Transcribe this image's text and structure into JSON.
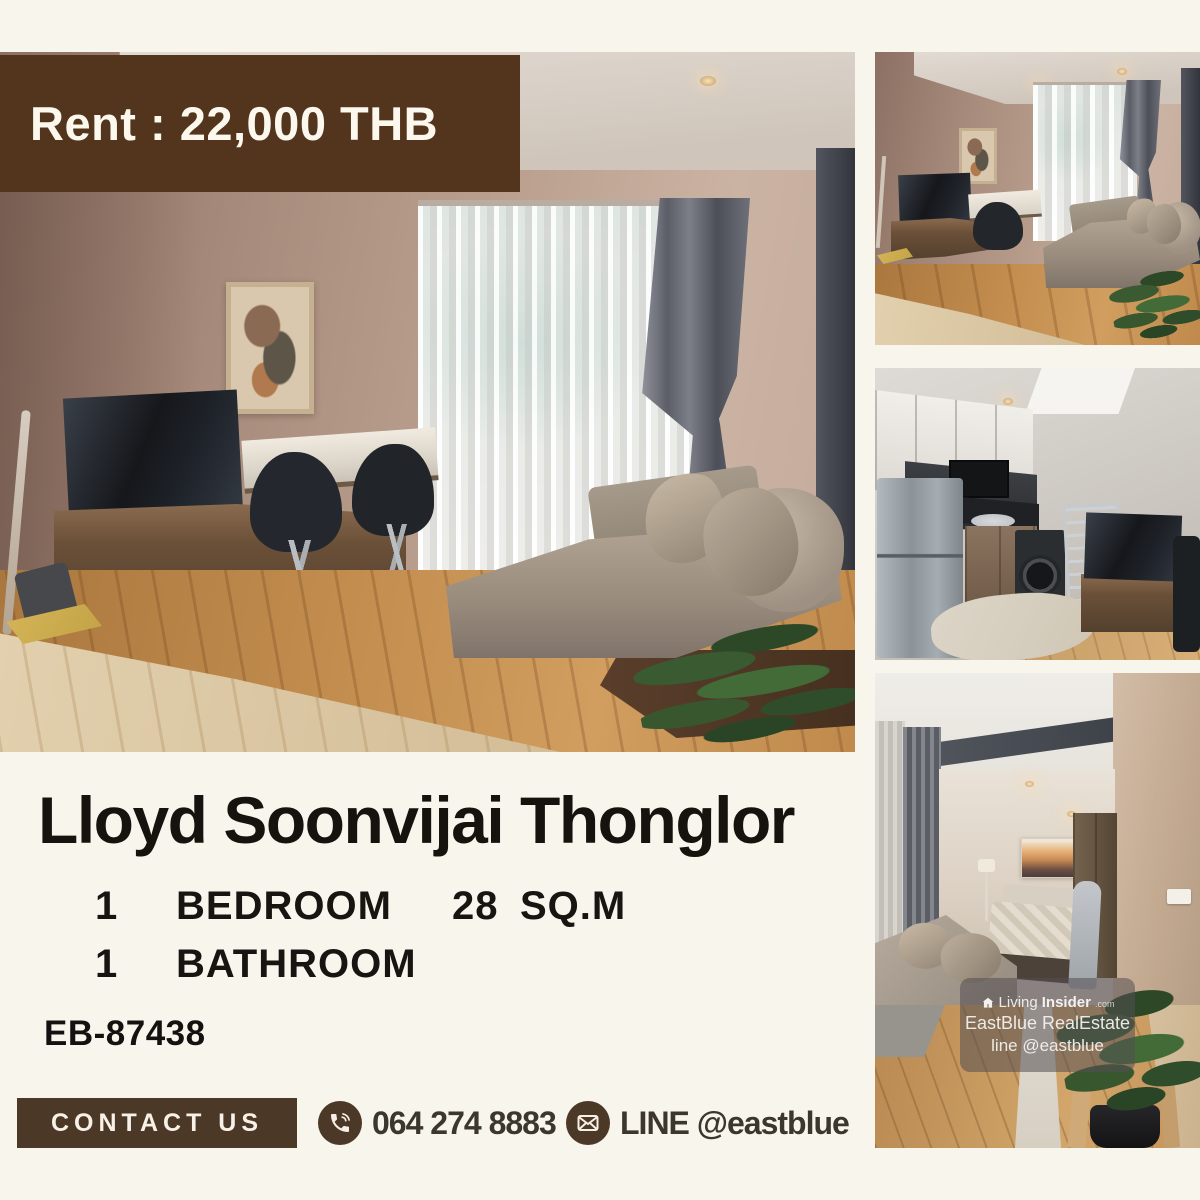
{
  "canvas": {
    "width": 1200,
    "height": 1200,
    "background": "#f8f5ec"
  },
  "price_banner": {
    "label": "Rent : 22,000 THB"
  },
  "listing": {
    "title": "Lloyd Soonvijai Thonglor",
    "bedroom_count": "1",
    "bedroom_label": "BEDROOM",
    "area_value": "28",
    "area_label": "SQ.M",
    "bathroom_count": "1",
    "bathroom_label": "BATHROOM",
    "ref_code": "EB-87438"
  },
  "contact": {
    "button_label": "CONTACT US",
    "phone_number": "064 274 8883",
    "line_id": "LINE @eastblue"
  },
  "watermark": {
    "brand_prefix": "Living",
    "brand_suffix": "Insider",
    "brand_domain": ".com",
    "agency": "EastBlue RealEstate",
    "line_handle": "line @eastblue"
  },
  "photos": [
    {
      "id": "main",
      "caption": "Living room with chaise sofa, TV cabinet, dining set and floor-to-ceiling window"
    },
    {
      "id": "top-right",
      "caption": "Living room wide angle"
    },
    {
      "id": "middle-right",
      "caption": "Kitchen with refrigerator, washing machine and TV"
    },
    {
      "id": "bottom-right",
      "caption": "Bedroom with sofa, bed and sunset painting"
    }
  ],
  "colors": {
    "accent_brown": "#53351d",
    "contact_brown": "#4c3826",
    "text_dark": "#16130e",
    "cream_background": "#f8f5ec"
  },
  "icons": {
    "phone": "phone-icon",
    "line": "envelope-icon",
    "brand": "house-logo-icon"
  }
}
